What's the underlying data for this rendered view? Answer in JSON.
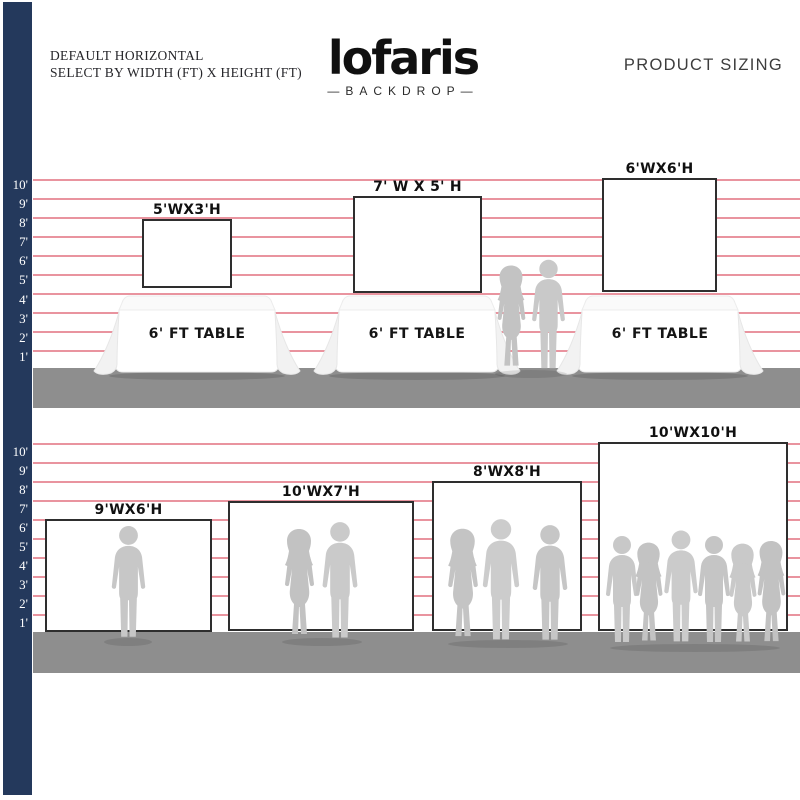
{
  "header": {
    "size_note_line1": "DEFAULT HORIZONTAL",
    "size_note_line2": "SELECT BY WIDTH (FT) X HEIGHT (FT)",
    "brand_name": "lofaris",
    "brand_sub": "BACKDROP",
    "brand_dash": "—",
    "product_sizing": "PRODUCT SIZING"
  },
  "ruler_labels": [
    "10'",
    "9'",
    "8'",
    "7'",
    "6'",
    "5'",
    "4'",
    "3'",
    "2'",
    "1'"
  ],
  "table_scene": {
    "table_label": "6' FT TABLE",
    "backdrops": [
      {
        "label": "5'WX3'H",
        "width_ft": 5,
        "height_ft": 3
      },
      {
        "label": "7' W X 5' H",
        "width_ft": 7,
        "height_ft": 5
      },
      {
        "label": "6'WX6'H",
        "width_ft": 6,
        "height_ft": 6
      }
    ]
  },
  "floor_scene": {
    "backdrops": [
      {
        "label": "9'WX6'H",
        "width_ft": 9,
        "height_ft": 6
      },
      {
        "label": "10'WX7'H",
        "width_ft": 10,
        "height_ft": 7
      },
      {
        "label": "8'WX8'H",
        "width_ft": 8,
        "height_ft": 8
      },
      {
        "label": "10'WX10'H",
        "width_ft": 10,
        "height_ft": 10
      }
    ]
  },
  "colors": {
    "ruler_bar": "#24395c",
    "gridline": "#e9949f",
    "floor": "#8e8e8e",
    "silhouette": "#c6c6c6",
    "backdrop_border": "#2e2e2e"
  }
}
